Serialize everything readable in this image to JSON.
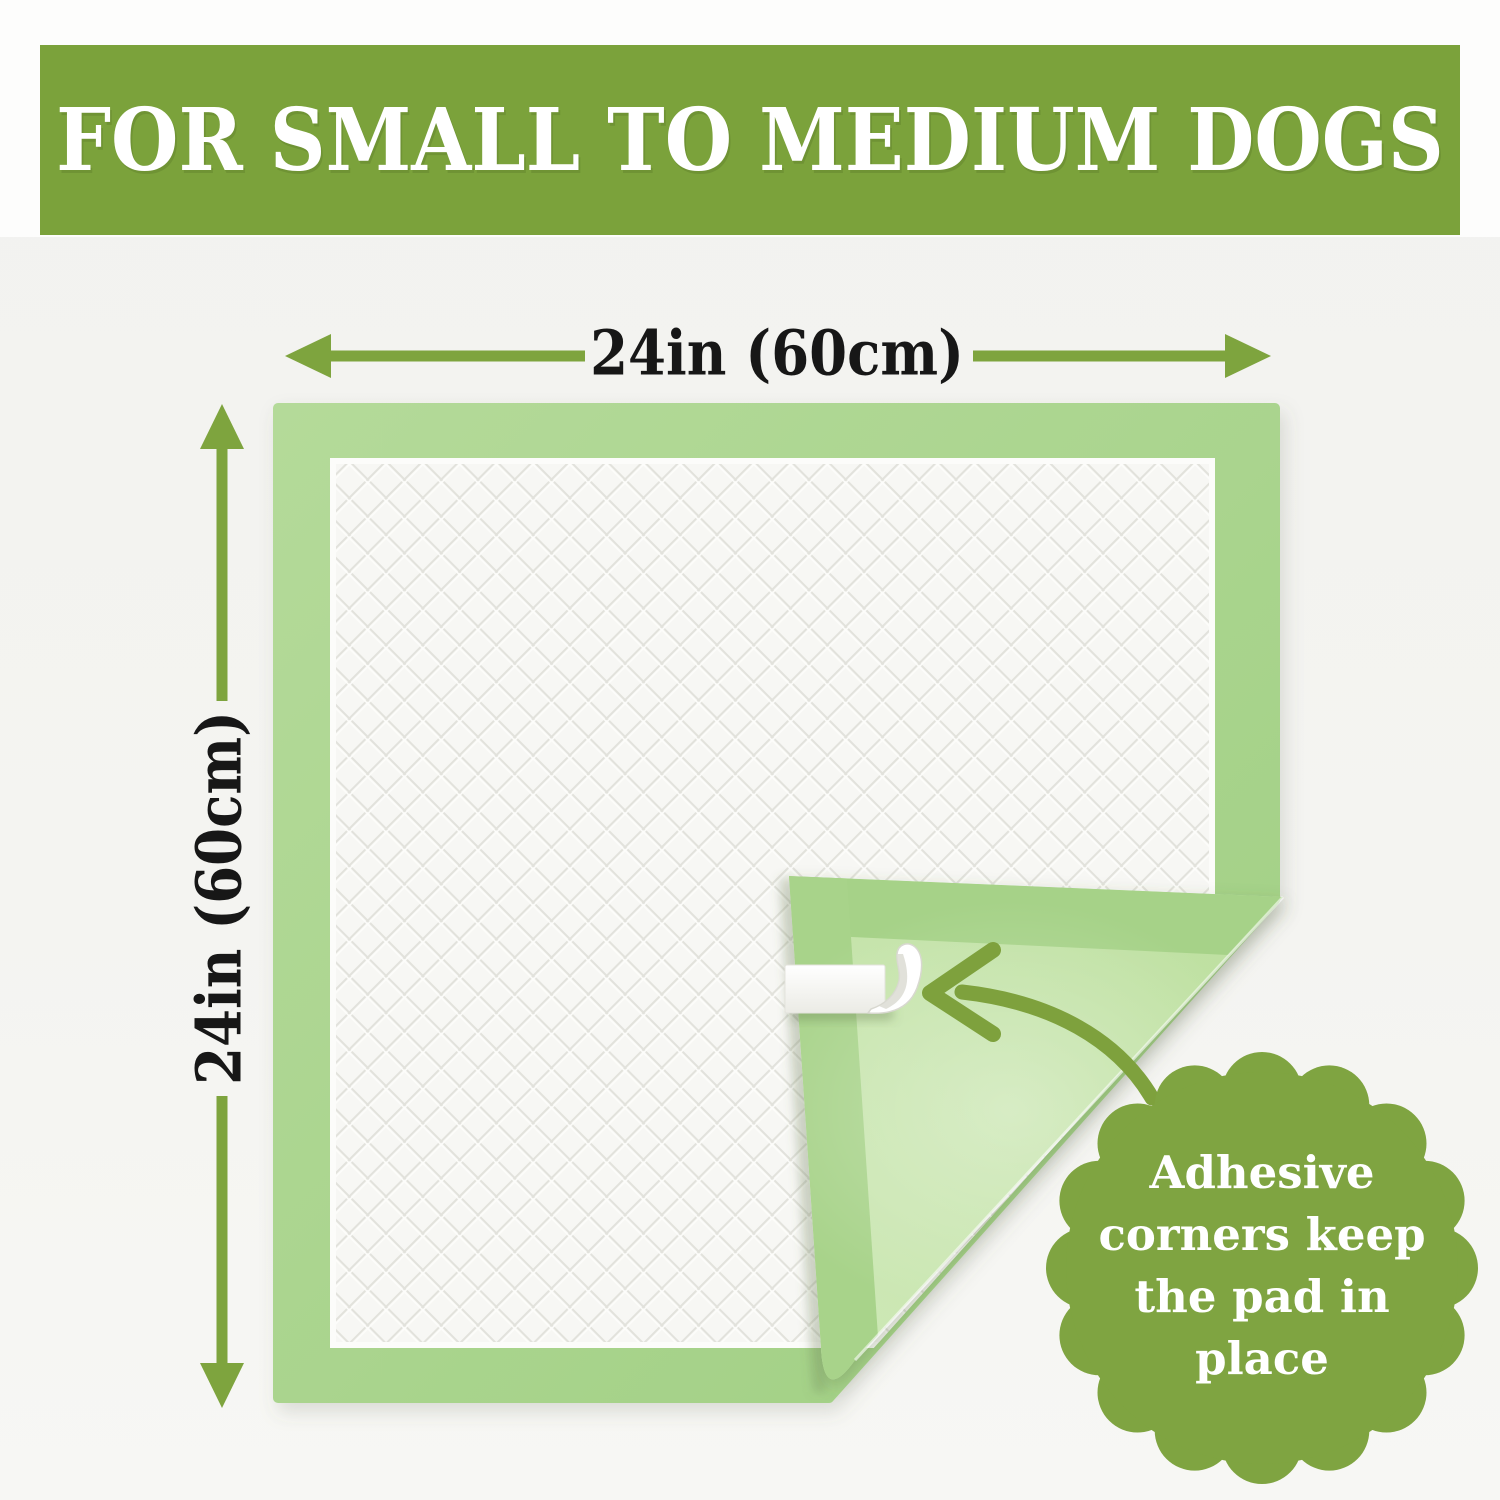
{
  "banner": {
    "title": "FOR SMALL TO MEDIUM DOGS"
  },
  "dimensions": {
    "width": "24in (60cm)",
    "height": "24in (60cm)"
  },
  "badge": {
    "lines": [
      "Adhesive",
      "corners keep",
      "the pad in",
      "place"
    ]
  },
  "icons": {
    "width_arrow": "left-right-dimension-arrow",
    "height_arrow": "up-down-dimension-arrow",
    "pointer": "curved-arrow",
    "seal": "scalloped-badge"
  },
  "colors": {
    "banner_green": "#7ba23b",
    "annotation_green": "#7ea43e",
    "badge_green": "#7fa441",
    "pad_border_green": "#aad38e",
    "flap_green": "#c3e1a7",
    "flap_seam_green": "#a6d288",
    "quilt_white": "#f7f7f4",
    "tape_white": "#ffffff",
    "dimension_text": "#171717",
    "background": "#f3f3f0"
  }
}
